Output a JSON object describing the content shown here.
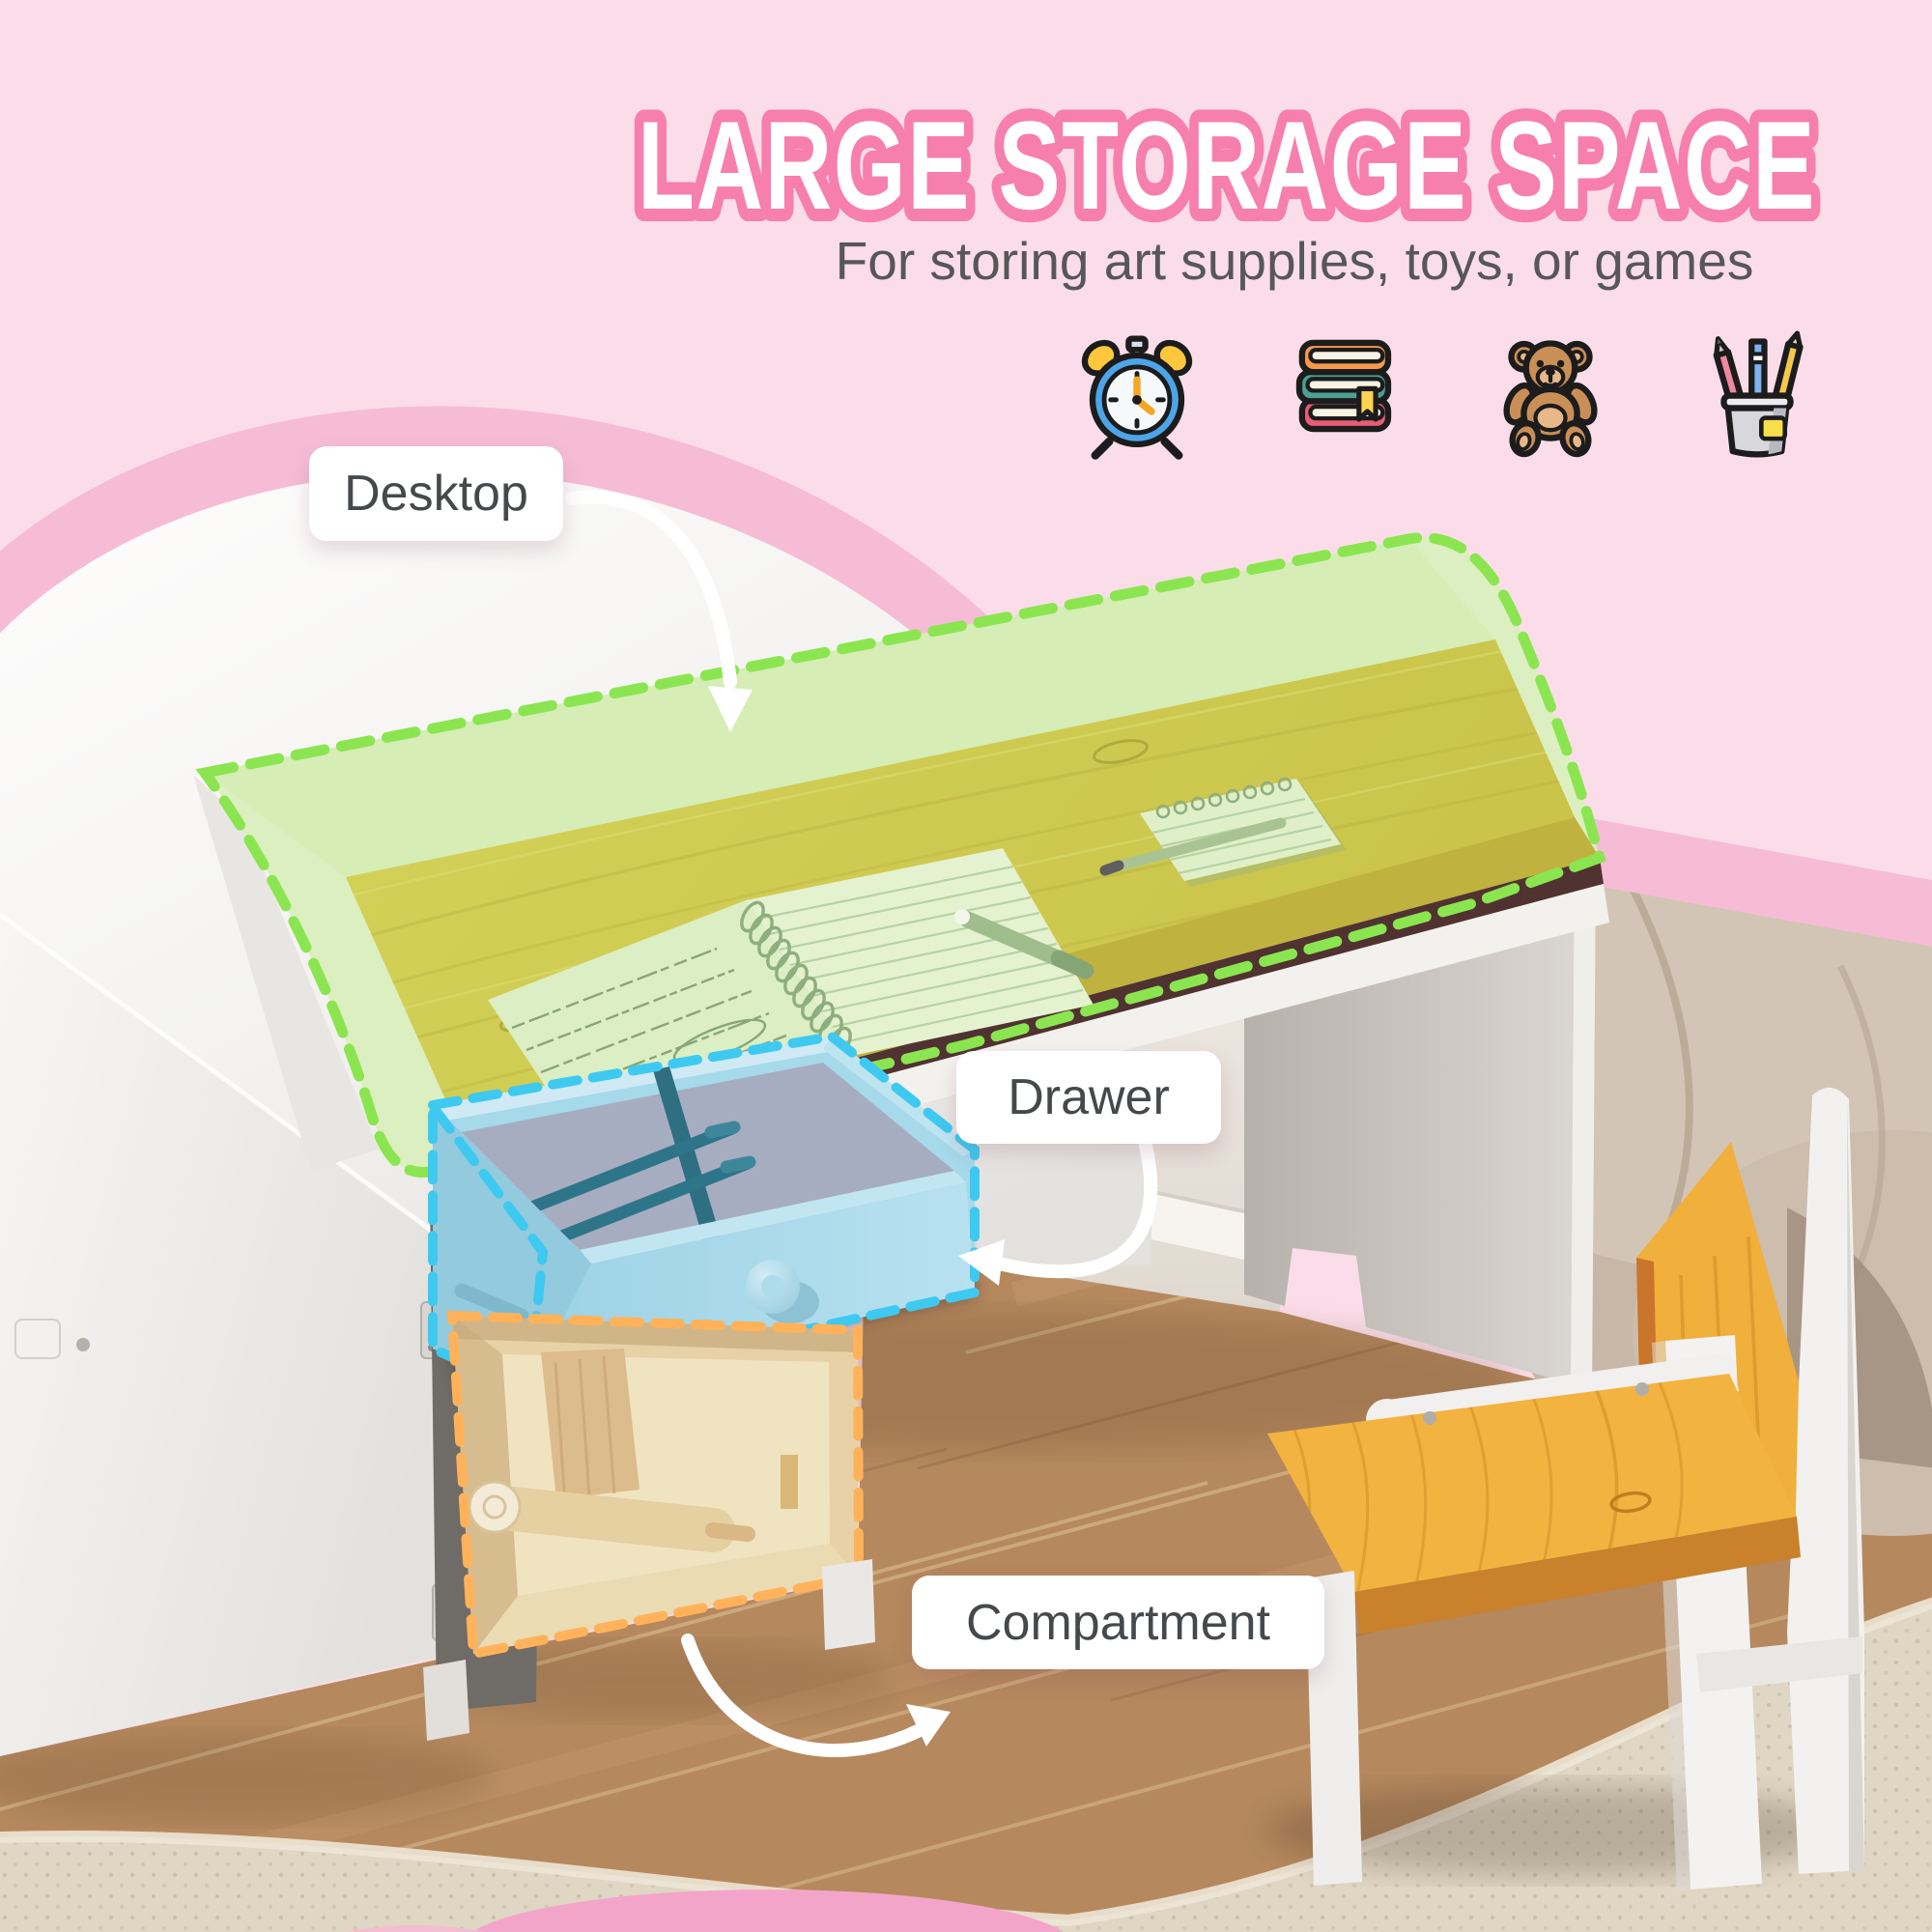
{
  "header": {
    "title": "LARGE STORAGE SPACE",
    "subtitle": "For storing art supplies, toys, or games"
  },
  "icons": [
    {
      "name": "alarm-clock-icon"
    },
    {
      "name": "books-stack-icon"
    },
    {
      "name": "teddy-bear-icon"
    },
    {
      "name": "pencil-cup-icon"
    }
  ],
  "callouts": [
    {
      "id": "desktop",
      "label": "Desktop",
      "highlight_color": "#8BE550"
    },
    {
      "id": "drawer",
      "label": "Drawer",
      "highlight_color": "#3EC9F1"
    },
    {
      "id": "compartment",
      "label": "Compartment",
      "highlight_color": "#FFB259"
    }
  ],
  "colors": {
    "background_pink": "#FBDDE9",
    "wave_pink": "#F6BCD6",
    "accent_pink": "#F77FAD",
    "title_fill": "#FFFFFF",
    "subtitle_gray": "#575757",
    "label_text": "#46494C",
    "label_bg": "#FFFFFF",
    "highlight_green": "#8BE550",
    "highlight_cyan": "#3EC9F1",
    "highlight_orange": "#FFB259",
    "arrow_white": "#FFFFFF",
    "desk_wood": "#E3C44B",
    "chair_wood": "#F2B340",
    "drawer_blue": "#A6D9EA",
    "compartment_tan": "#E7D2A8"
  }
}
